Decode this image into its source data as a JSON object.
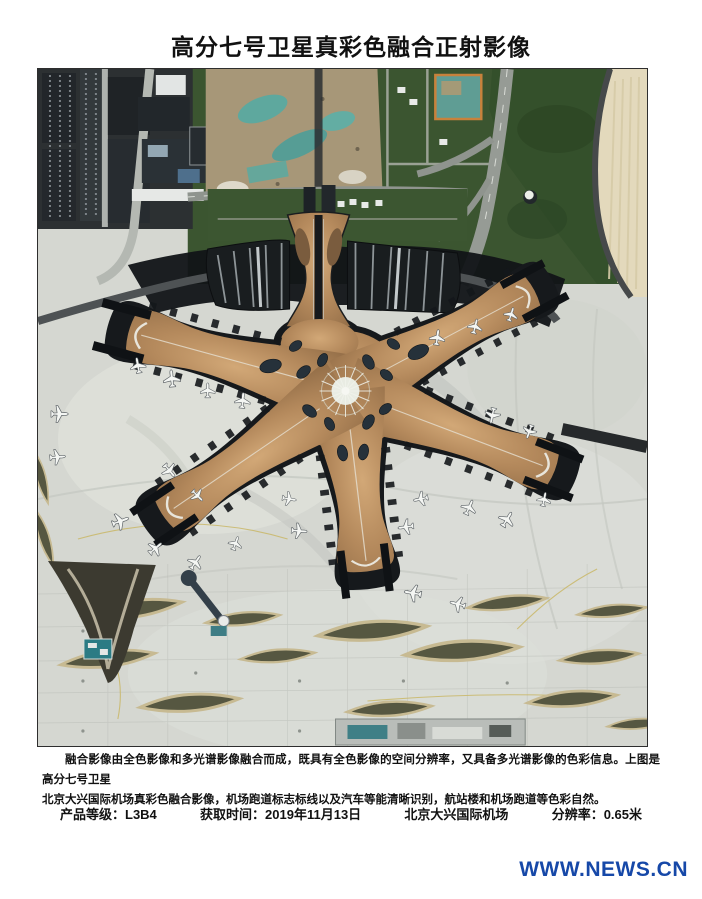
{
  "title": "高分七号卫星真彩色融合正射影像",
  "caption": {
    "lines": [
      "融合影像由全色影像和多光谱影像融合而成，既具有全色影像的空间分辨率，又具备多光谱影像的色彩信息。上图是高分七号卫星",
      "北京大兴国际机场真彩色融合影像，机场跑道标志标线以及汽车等能清晰识别，航站楼和机场跑道等色彩自然。"
    ]
  },
  "meta": {
    "items": [
      "产品等级：L3B4",
      "获取时间：2019年11月13日",
      "北京大兴国际机场",
      "分辨率：0.65米"
    ]
  },
  "watermark": {
    "text": "WWW.NEWS.CN",
    "color": "#1648a8"
  },
  "image_colors": {
    "terminal_copper": "#b4895c",
    "apron_concrete": "#d5d7d1",
    "vegetation_green": "#3b5530",
    "shadow_dark": "#16191c",
    "sand_apron": "#e3d9bc"
  }
}
